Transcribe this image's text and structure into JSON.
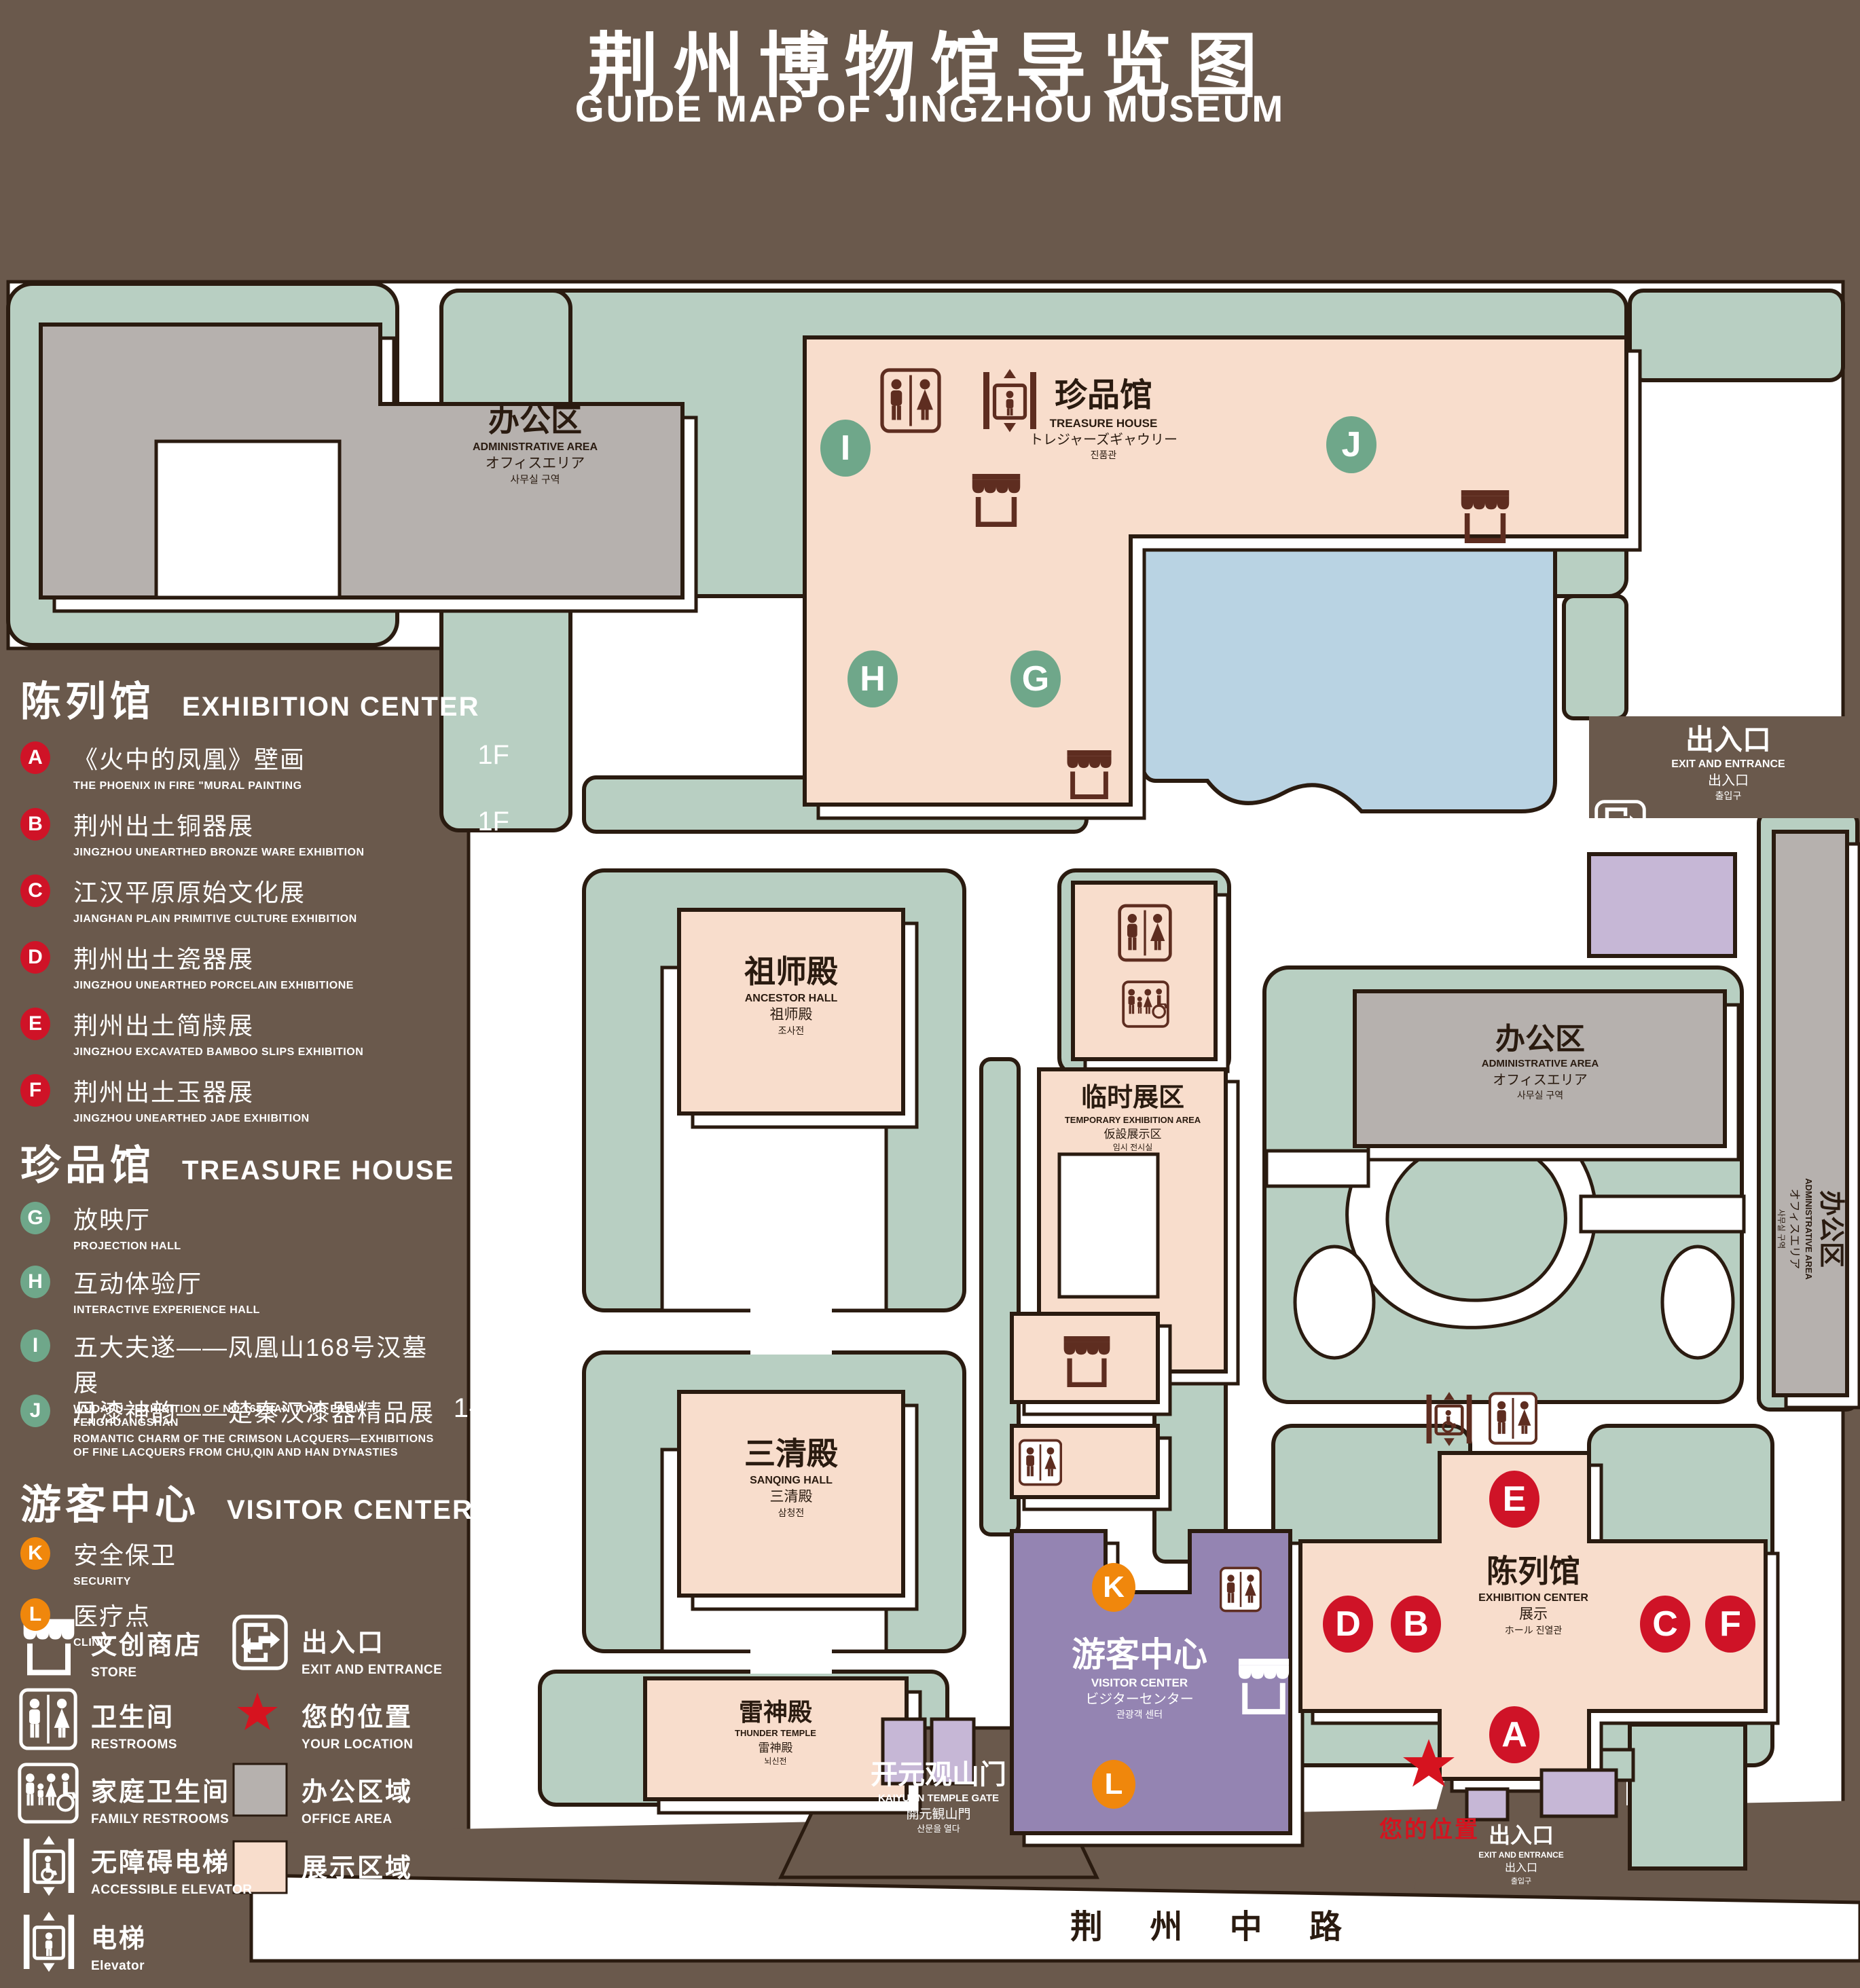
{
  "title": {
    "zh": "荆州博物馆导览图",
    "en": "GUIDE MAP OF JINGZHOU MUSEUM"
  },
  "colors": {
    "background_brown": "#6a594c",
    "map_green": "#b8cfc2",
    "display_pink": "#f8ddcc",
    "office_gray": "#b6b1ae",
    "pond_blue": "#b9d3e3",
    "visitor_purple": "#9484b2",
    "gate_purple": "#c6b7d6",
    "marker_red": "#cf1327",
    "marker_green": "#6fa78a",
    "marker_orange": "#f0870c",
    "location_red": "#d6131f",
    "outline_dark": "#2a1b10"
  },
  "legend": {
    "sections": [
      {
        "zh": "陈列馆",
        "en": "EXHIBITION CENTER",
        "items": [
          {
            "letter": "A",
            "zh": "《火中的凤凰》壁画",
            "en": "THE PHOENIX IN FIRE \"MURAL PAINTING",
            "floor": "1F"
          },
          {
            "letter": "B",
            "zh": "荆州出土铜器展",
            "en": "JINGZHOU UNEARTHED BRONZE WARE EXHIBITION",
            "floor": "1F"
          },
          {
            "letter": "C",
            "zh": "江汉平原原始文化展",
            "en": "JIANGHAN PLAIN PRIMITIVE CULTURE EXHIBITION",
            "floor": "1F"
          },
          {
            "letter": "D",
            "zh": "荆州出土瓷器展",
            "en": "JINGZHOU UNEARTHED PORCELAIN EXHIBITIONE",
            "floor": "2F"
          },
          {
            "letter": "E",
            "zh": "荆州出土简牍展",
            "en": "JINGZHOU EXCAVATED BAMBOO SLIPS EXHIBITION",
            "floor": "2F"
          },
          {
            "letter": "F",
            "zh": "荆州出土玉器展",
            "en": "JINGZHOU UNEARTHED JADE EXHIBITION",
            "floor": "2F"
          }
        ]
      },
      {
        "zh": "珍品馆",
        "en": "TREASURE HOUSE",
        "items": [
          {
            "letter": "G",
            "zh": "放映厅",
            "en": "PROJECTION HALL",
            "floor": "1F"
          },
          {
            "letter": "H",
            "zh": "互动体验厅",
            "en": "INTERACTIVE EXPERIENCE HALL",
            "floor": "1F"
          },
          {
            "letter": "I",
            "zh": "五大夫遂——凤凰山168号汉墓展",
            "en": "WUDAFU—EXHIBITION OF NO.168 HAN TOMB FROM FENGHUANGSHAN",
            "floor": "2F"
          },
          {
            "letter": "J",
            "zh": "丹漆神韵——楚秦汉漆器精品展",
            "en": "ROMANTIC CHARM OF THE CRIMSON LACQUERS—EXHIBITIONS OF FINE LACQUERS FROM CHU,QIN AND HAN DYNASTIES",
            "floor": "1-2F"
          }
        ]
      },
      {
        "zh": "游客中心",
        "en": "VISITOR CENTER",
        "items": [
          {
            "letter": "K",
            "zh": "安全保卫",
            "en": "SECURITY",
            "floor": "1F"
          },
          {
            "letter": "L",
            "zh": "医疗点",
            "en": "CLINIC",
            "floor": "1F"
          }
        ]
      }
    ],
    "pictograms": [
      {
        "zh": "文创商店",
        "en": "STORE"
      },
      {
        "zh": "卫生间",
        "en": "RESTROOMS"
      },
      {
        "zh": "家庭卫生间",
        "en": "FAMILY RESTROOMS"
      },
      {
        "zh": "无障碍电梯",
        "en": "ACCESSIBLE ELEVATOR"
      },
      {
        "zh": "电梯",
        "en": "Elevator"
      },
      {
        "zh": "出入口",
        "en": "EXIT AND ENTRANCE"
      },
      {
        "zh": "您的位置",
        "en": "YOUR LOCATION"
      },
      {
        "zh": "办公区域",
        "en": "OFFICE AREA"
      },
      {
        "zh": "展示区域",
        "en": "DISPLAY AREA"
      }
    ]
  },
  "map": {
    "labels": {
      "admin_tl": {
        "zh": "办公区",
        "en": "ADMINISTRATIVE AREA",
        "jp": "オフィスエリア",
        "kr": "사무실 구역"
      },
      "treasure": {
        "zh": "珍品馆",
        "en": "TREASURE HOUSE",
        "jp": "トレジャーズギャウリー",
        "kr": "진품관"
      },
      "ancestor": {
        "zh": "祖师殿",
        "en": "ANCESTOR HALL",
        "jp": "祖师殿",
        "kr": "조사전"
      },
      "sanqing": {
        "zh": "三清殿",
        "en": "SANQING HALL",
        "jp": "三清殿",
        "kr": "삼청전"
      },
      "thunder": {
        "zh": "雷神殿",
        "en": "THUNDER TEMPLE",
        "jp": "雷神殿",
        "kr": "뇌신전"
      },
      "temporary": {
        "zh": "临时展区",
        "en": "TEMPORARY EXHIBITION AREA",
        "jp": "仮設展示区",
        "kr": "임시 전시실"
      },
      "visitor": {
        "zh": "游客中心",
        "en": "VISITOR CENTER",
        "jp": "ビジターセンター",
        "kr": "관광객 센터"
      },
      "admin_r": {
        "zh": "办公区",
        "en": "ADMINISTRATIVE AREA",
        "jp": "オフィスエリア",
        "kr": "사무실 구역"
      },
      "admin_strip": {
        "zh": "办公区",
        "en": "ADMINISTRATIVE AREA",
        "jp": "オフィスエリア",
        "kr": "사무실 구역"
      },
      "exhibition": {
        "zh": "陈列馆",
        "en": "EXHIBITION CENTER",
        "jp": "展示",
        "kr": "ホール 진열관"
      },
      "exit_tr": {
        "zh": "出入口",
        "en": "EXIT AND ENTRANCE",
        "jp": "出入口",
        "kr": "출입구"
      },
      "exit_br": {
        "zh": "出入口",
        "en": "EXIT AND ENTRANCE",
        "jp": "出入口",
        "kr": "출입구"
      },
      "gate": {
        "zh": "开元观山门",
        "en": "KAIYUAN TEMPLE GATE",
        "jp": "開元観山門",
        "kr": "산문을 열다"
      },
      "road": "荆 州 中 路",
      "your_location": "您的位置"
    },
    "badges": {
      "green": [
        "I",
        "J",
        "H",
        "G"
      ],
      "red": [
        "E",
        "D",
        "B",
        "C",
        "F",
        "A"
      ],
      "orange": [
        "K",
        "L"
      ]
    }
  }
}
